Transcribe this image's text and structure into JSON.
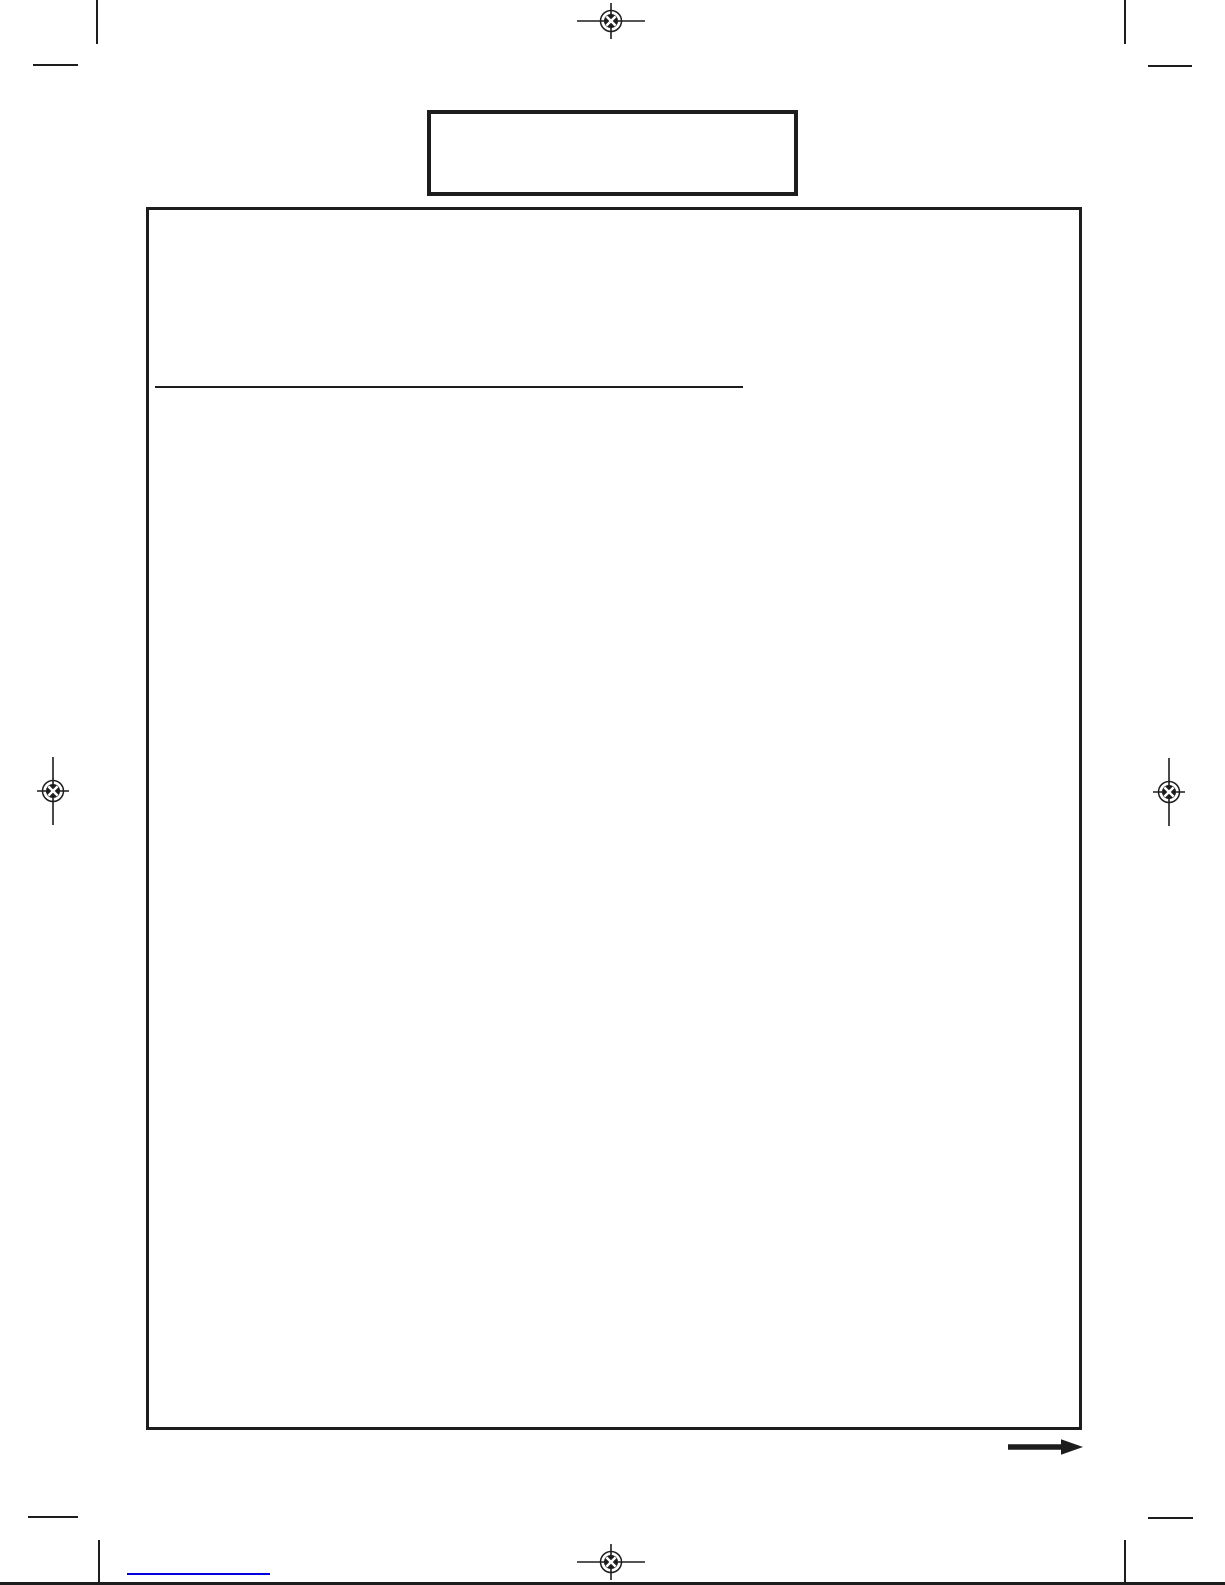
{
  "page": {
    "kind": "blank scanned manual page",
    "visible_text": "",
    "header_box_text": "",
    "content_frame_text": ""
  },
  "colors": {
    "ink": "#1d1d1d",
    "link": "#0000e0",
    "paper": "#ffffff"
  },
  "icons": {
    "registration_marks": [
      "top-center",
      "left-middle",
      "right-middle",
      "bottom-center"
    ],
    "crop_marks": [
      "top-left",
      "top-right",
      "bottom-left",
      "bottom-right"
    ],
    "arrow": "right-arrow"
  }
}
